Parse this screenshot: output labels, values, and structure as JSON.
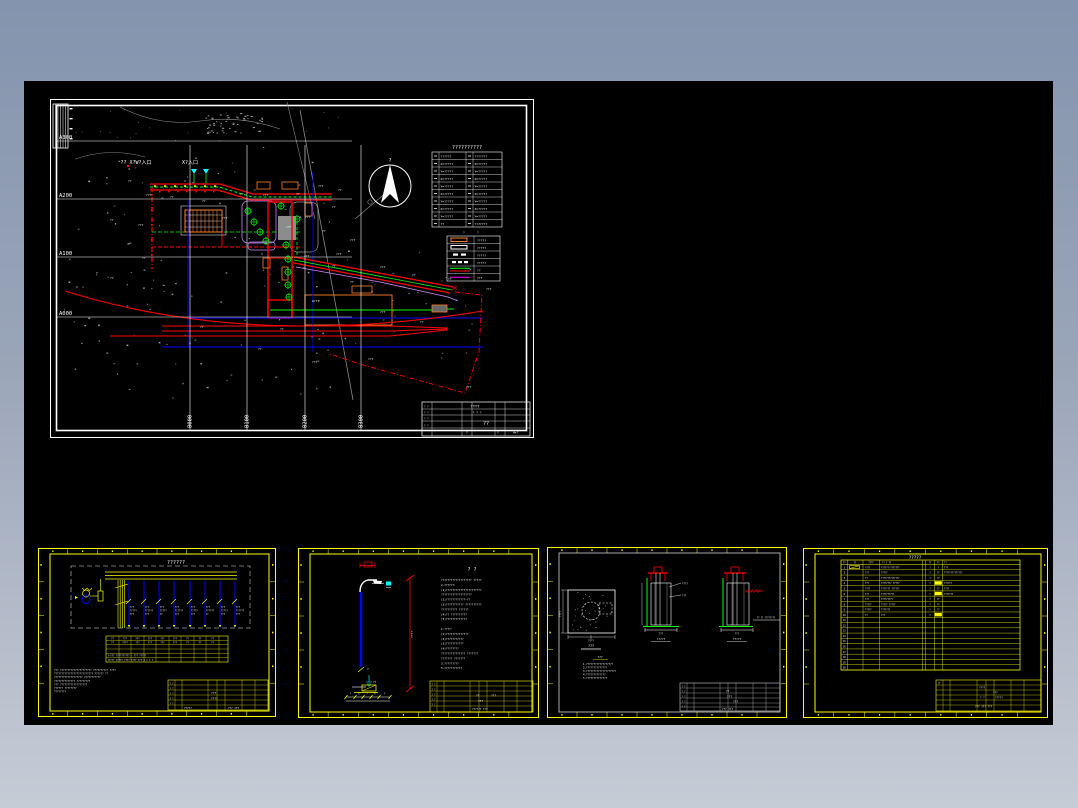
{
  "app": {
    "background_top": "#8494ae",
    "background_bottom": "#c6ccd6",
    "canvas_color": "#000000",
    "accent_yellow": "#ffff00",
    "accent_red": "#ff0000",
    "accent_green": "#00ff00",
    "accent_blue": "#0000ff",
    "accent_cyan": "#00ffff",
    "accent_orange": "#ff7f2a",
    "accent_violet": "#cc88ff"
  },
  "site_plan": {
    "grid_rows": [
      "A300",
      "A200",
      "A100",
      "A000"
    ],
    "grid_cols": [
      "B000",
      "B100",
      "B200",
      "B300"
    ],
    "north_mark": "?",
    "entrance1": "?? X?W?入口",
    "entrance2": "X?入口",
    "coord_table": {
      "title": "??????????",
      "rows": [
        {
          "l": "??????",
          "r": "???????"
        },
        {
          "l": "X=?????",
          "r": "X=?????"
        },
        {
          "l": "Y=?????",
          "r": "Y=?????"
        },
        {
          "l": "X=?????",
          "r": "X=?????"
        },
        {
          "l": "Y=?????",
          "r": "Y=?????"
        },
        {
          "l": "X=?????",
          "r": "X=?????"
        },
        {
          "l": "Y=?????",
          "r": "Y=?????"
        },
        {
          "l": "X=?????",
          "r": "X=?????"
        },
        {
          "l": "Y=?????",
          "r": "Y=?????"
        },
        {
          "l": "??",
          "r": "???????"
        }
      ]
    },
    "legend": {
      "h1": "?",
      "h2": "?",
      "rows": [
        {
          "label": "?????"
        },
        {
          "label": "?????"
        },
        {
          "label": "?????"
        },
        {
          "label": "?????"
        },
        {
          "label": "??"
        },
        {
          "label": "???"
        }
      ]
    },
    "title_block": {
      "t1": "TTTT",
      "t2": "? ? ?",
      "stamp": "??",
      "l1": "? ?",
      "l2": "? ?",
      "l3": "? ?",
      "l4": "? ?",
      "b1": "?",
      "b2": "?",
      "b3": "H×?"
    },
    "annotations": [
      {
        "x": 78,
        "y": 83,
        "t": "??"
      },
      {
        "x": 96,
        "y": 97,
        "t": "???"
      },
      {
        "x": 120,
        "y": 99,
        "t": "??"
      },
      {
        "x": 60,
        "y": 122,
        "t": "??"
      },
      {
        "x": 88,
        "y": 127,
        "t": "???"
      },
      {
        "x": 152,
        "y": 103,
        "t": "??"
      },
      {
        "x": 172,
        "y": 120,
        "t": "???"
      },
      {
        "x": 190,
        "y": 96,
        "t": "??"
      },
      {
        "x": 213,
        "y": 97,
        "t": "???"
      },
      {
        "x": 246,
        "y": 96,
        "t": "??"
      },
      {
        "x": 268,
        "y": 88,
        "t": "???"
      },
      {
        "x": 288,
        "y": 92,
        "t": "??"
      },
      {
        "x": 282,
        "y": 109,
        "t": "??"
      },
      {
        "x": 255,
        "y": 119,
        "t": "???"
      },
      {
        "x": 272,
        "y": 133,
        "t": "??"
      },
      {
        "x": 236,
        "y": 129,
        "t": "???"
      },
      {
        "x": 300,
        "y": 142,
        "t": "???"
      },
      {
        "x": 286,
        "y": 156,
        "t": "???"
      },
      {
        "x": 330,
        "y": 169,
        "t": "???"
      },
      {
        "x": 362,
        "y": 177,
        "t": "??"
      },
      {
        "x": 300,
        "y": 184,
        "t": "??"
      },
      {
        "x": 262,
        "y": 203,
        "t": "U???"
      },
      {
        "x": 330,
        "y": 214,
        "t": "???"
      },
      {
        "x": 370,
        "y": 224,
        "t": "??"
      },
      {
        "x": 208,
        "y": 251,
        "t": "??"
      },
      {
        "x": 262,
        "y": 264,
        "t": "???"
      },
      {
        "x": 318,
        "y": 261,
        "t": "???"
      },
      {
        "x": 416,
        "y": 289,
        "t": "???"
      },
      {
        "x": 436,
        "y": 191,
        "t": "???"
      },
      {
        "x": 398,
        "y": 181,
        "t": "??"
      },
      {
        "x": 92,
        "y": 160,
        "t": "??"
      },
      {
        "x": 60,
        "y": 180,
        "t": "??"
      },
      {
        "x": 150,
        "y": 229,
        "t": "??"
      },
      {
        "x": 230,
        "y": 231,
        "t": "??"
      },
      {
        "x": 254,
        "y": 158,
        "t": "???"
      },
      {
        "x": 282,
        "y": 168,
        "t": "??"
      }
    ]
  },
  "sheet1": {
    "title": "??????",
    "feeders": [
      {
        "a": "???",
        "b": "?????",
        "c": "???"
      },
      {
        "a": "???",
        "b": "??????",
        "c": "???"
      },
      {
        "a": "???",
        "b": "?????",
        "c": "??"
      },
      {
        "a": "???",
        "b": "??????",
        "c": "???"
      },
      {
        "a": "???",
        "b": "?????",
        "c": "???"
      },
      {
        "a": "???",
        "b": "??????",
        "c": "??"
      },
      {
        "a": "???",
        "b": "?????",
        "c": "???"
      },
      {
        "a": "???",
        "b": "??????",
        "c": "???"
      }
    ],
    "table_headers": [
      "??",
      "???",
      "???",
      "???",
      "???",
      "???",
      "??",
      "??",
      "??"
    ],
    "table_row1": [
      "??",
      "????",
      "???",
      "???",
      "???",
      "???",
      "??",
      "??",
      "??"
    ],
    "table_row4": "?—??? ?????????? — ??? ?????",
    "table_row5": "????? ????? ???? ???? ??? ? ? ? ?",
    "notes": [
      "??? ????????????????????? ?????????? ????",
      "?????????????????????????? ?????? ??",
      "??????????????????? ???????????",
      "?????????????? ?????????",
      "??? ??????????????????",
      "?????? ????????",
      "????????"
    ],
    "title_block": {
      "c1": "???",
      "c2": "????",
      "w1": "?????",
      "w2": "??? ???",
      "l": "? ?"
    }
  },
  "sheet2": {
    "title": "?   ?",
    "pole_dim": "????",
    "bottom_dims": [
      "?",
      "??",
      "?",
      "??",
      "?"
    ],
    "ground_label": "??",
    "lamp_label": "?",
    "notes": [
      "??????????????????? ?????",
      "2.??????:",
      "(1)??????????????????????",
      "   ???????????????????",
      "(2)????????????—??",
      "(3)??????????? ??????????",
      "   ?????????? ??????",
      "(4)?? ??????????",
      "(5)?????????????",
      "",
      "1.????:",
      "(1)??????????????",
      "(2)???????????",
      "(3)???????????",
      "(4)????????",
      "   ??????????????? ???????",
      "             ??????? ???????",
      "3.?????????",
      "5.???????????"
    ],
    "title_block": {
      "c1": "??",
      "c2": "???",
      "c3": "???",
      "w1": "?????? ???",
      "l": "? ?"
    }
  },
  "sheet3": {
    "fig_a_label": "???",
    "fig_a_dim_bottom": "????",
    "fig_a_dim_left": "????",
    "fig_b_label": "?????",
    "fig_b_dim": "???",
    "fig_b_callout1": "????",
    "fig_b_callout2": "???",
    "fig_c_label": "?????",
    "fig_c_dim": "???",
    "fig_c_grade": "?? ?? ????????",
    "notes_title": "???",
    "notes": [
      "1.??????????????????",
      "2.??????????????",
      "3.????????????????????",
      "4.?????????????",
      "5.??????????????"
    ],
    "title_block": {
      "c1": "??",
      "c2": "???",
      "c3": "???",
      "w1": "??? ???",
      "l": "? ?"
    }
  },
  "sheet4": {
    "title": "?????",
    "headers": [
      "??",
      "??",
      "????",
      "?? ? ??",
      "??",
      "??",
      "??"
    ],
    "rows": [
      {
        "no": "1",
        "model": "????",
        "name": "??????-???????",
        "unit": "?",
        "qty": "?",
        "remark": "???"
      },
      {
        "no": "2",
        "model": "???",
        "name": "?????",
        "unit": "?",
        "qty": "??",
        "remark": "??????????????"
      },
      {
        "no": "3",
        "model": "??",
        "name": "??????????????",
        "unit": "?",
        "qty": "??",
        "remark": ""
      },
      {
        "no": "4",
        "model": "???",
        "name": "???????? ?????",
        "unit": "?",
        "qty": "",
        "hl": true,
        "remark": "??????"
      },
      {
        "no": "5",
        "model": "????",
        "name": "??????? ??????",
        "unit": "?",
        "qty": "??",
        "remark": "????"
      },
      {
        "no": "6",
        "model": "???",
        "name": "??????????",
        "unit": "?",
        "qty": "",
        "hl": true,
        "remark": "???????"
      },
      {
        "no": "7",
        "model": "???",
        "name": "?????????",
        "unit": "?",
        "qty": "??",
        "remark": ""
      },
      {
        "no": "8",
        "model": "?????",
        "name": "?????  ?????",
        "unit": "?",
        "qty": "??",
        "remark": ""
      },
      {
        "no": "9",
        "model": "?????",
        "name": "???????",
        "unit": "?",
        "qty": "??",
        "remark": ""
      },
      {
        "no": "10",
        "model": "??",
        "name": "???",
        "unit": "?",
        "qty": "",
        "hl": true,
        "remark": ""
      },
      {
        "no": "11"
      },
      {
        "no": "12"
      },
      {
        "no": "13"
      },
      {
        "no": "14"
      },
      {
        "no": "15"
      },
      {
        "no": "16"
      },
      {
        "no": "17"
      },
      {
        "no": "18"
      },
      {
        "no": "19"
      },
      {
        "no": "20"
      }
    ],
    "title_block": {
      "logo": "?",
      "a": "????",
      "b": "???",
      "c": "? ?",
      "d": "?????",
      "w": "??? ??? ???"
    }
  }
}
